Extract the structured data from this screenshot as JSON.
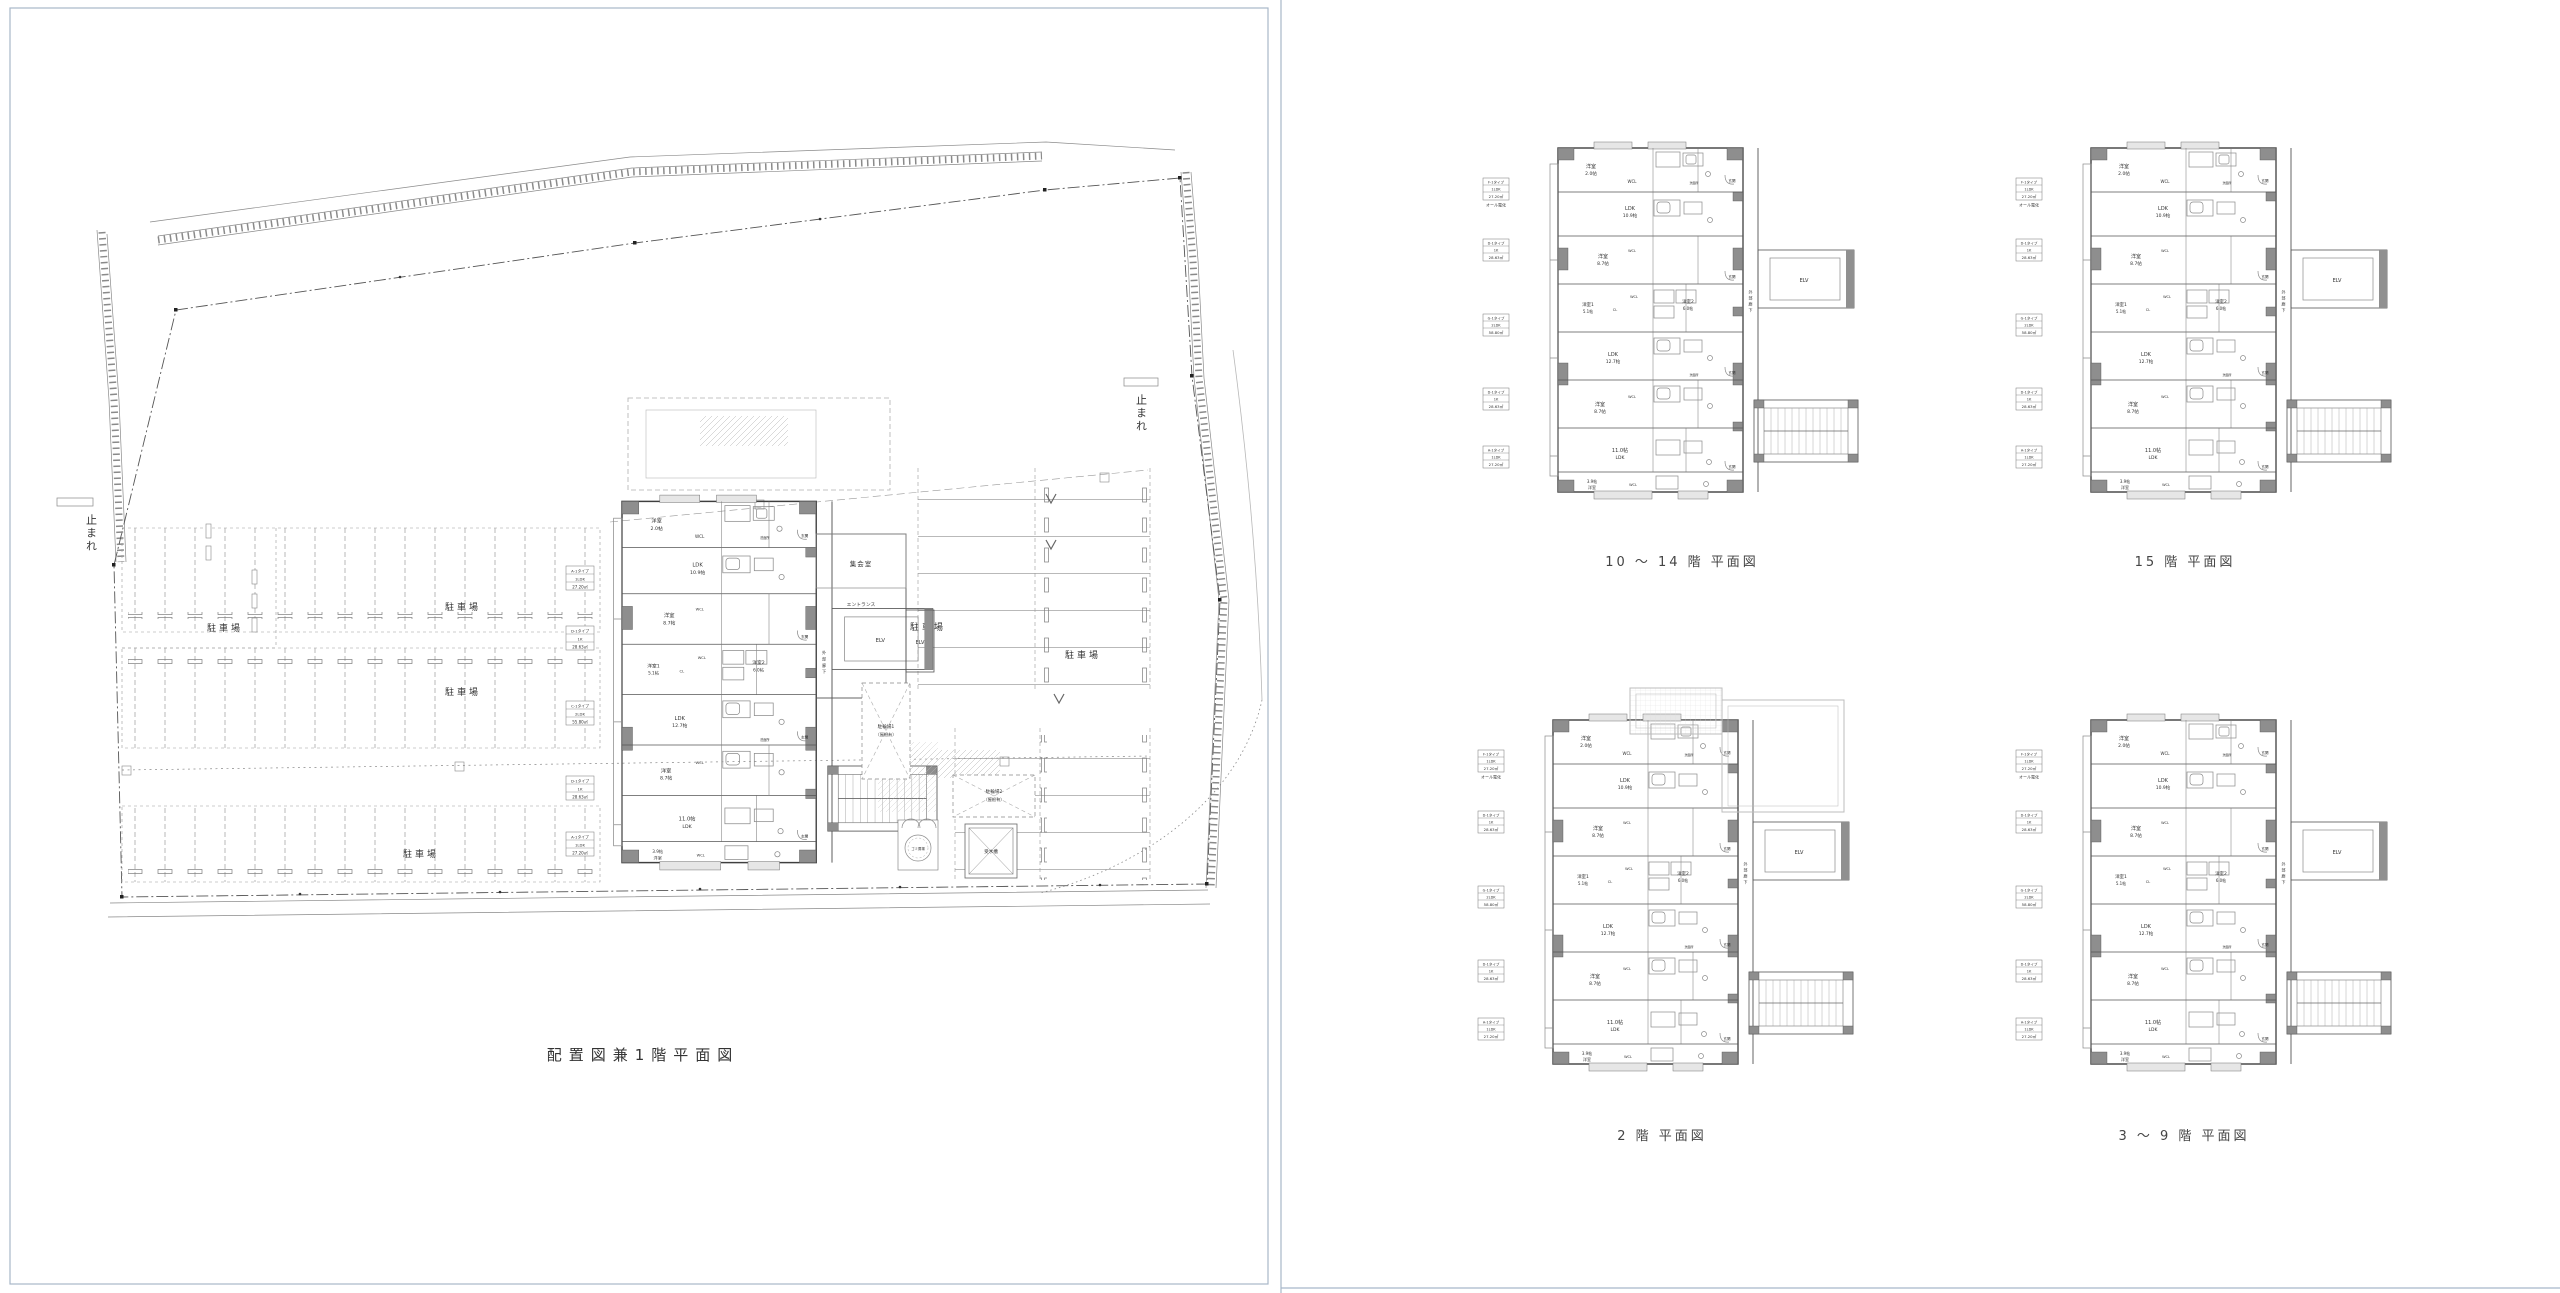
{
  "page": {
    "background": "#ffffff",
    "page_border_color": "#a8b7c9",
    "ink": "#3f3f3f",
    "poche_gray": "#8e8e8e"
  },
  "left_panel": {
    "title": "配置図兼1階平面図",
    "stop_signs": [
      "止まれ",
      "止まれ"
    ],
    "parking_labels": [
      "駐車場",
      "駐車場",
      "駐車場",
      "駐車場",
      "駐車場",
      "駐車場"
    ],
    "bicycle_parking_1": {
      "name": "駐輪場1",
      "note": "（屋根有）"
    },
    "bicycle_parking_2": {
      "name": "駐輪場2",
      "note": "（屋根有）"
    },
    "facilities": {
      "water_tank": "受水槽",
      "garbage": "ゴミ置場"
    },
    "building": {
      "meeting_room": "集会室",
      "entrance_hall": "エントランス"
    },
    "unit_tags": [
      {
        "code": "A-1タイプ",
        "type": "1LDK",
        "area": "27.20㎡"
      },
      {
        "code": "D-1タイプ",
        "type": "1K",
        "area": "28.63㎡"
      },
      {
        "code": "C-1タイプ",
        "type": "2LDK",
        "area": "55.80㎡"
      },
      {
        "code": "D-1タイプ",
        "type": "1K",
        "area": "28.63㎡"
      },
      {
        "code": "A-1タイプ",
        "type": "1LDK",
        "area": "27.20㎡"
      }
    ]
  },
  "typical_plan": {
    "rooms": {
      "yoshitsu": "洋室",
      "yoshitsu1": "洋室1",
      "yoshitsu2": "洋室2",
      "ldk": "LDK",
      "wcl": "WCL",
      "cl": "CL",
      "genkan": "玄関",
      "senmenjo": "洗面所",
      "elv": "ELV",
      "gaibu_roka": "外部廊下",
      "size_2_0": "2.0帖",
      "size_10_9": "10.9帖",
      "size_8_7": "8.7帖",
      "size_5_1": "5.1帖",
      "size_6_0": "6.0帖",
      "size_12_7": "12.7帖",
      "size_11_0": "11.0帖",
      "size_3_9": "3.9帖"
    },
    "unit_tags": [
      {
        "code": "F-1タイプ",
        "type": "1LDK",
        "area": "27.20㎡",
        "note": "オール電化"
      },
      {
        "code": "D-1タイプ",
        "type": "1K",
        "area": "28.63㎡"
      },
      {
        "code": "G-1タイプ",
        "type": "2LDK",
        "area": "58.80㎡"
      },
      {
        "code": "D-1タイプ",
        "type": "1K",
        "area": "28.63㎡"
      },
      {
        "code": "A-1タイプ",
        "type": "1LDK",
        "area": "27.20㎡"
      }
    ]
  },
  "right_panel": {
    "captions": [
      "10 ～ 14 階 平面図",
      "15 階 平面図",
      "2 階 平面図",
      "3 ～ 9 階 平面図"
    ]
  }
}
